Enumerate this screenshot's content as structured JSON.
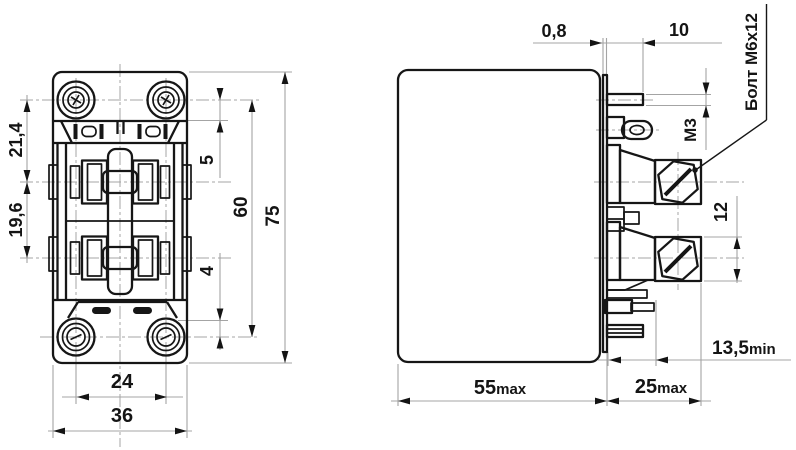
{
  "drawing": {
    "kind": "relay dimensional drawing, two views",
    "front_view": {
      "labels": {
        "hole_to_upper_contact": "21,4",
        "contact_row_spacing": "19,6",
        "top_screw_inset": "5",
        "bottom_screw_inset": "4",
        "mount_hole_vertical_spacing": "60",
        "overall_height": "75",
        "mount_hole_horizontal_spacing": "24",
        "overall_width": "36"
      }
    },
    "side_view": {
      "labels": {
        "flange_thickness": "0,8",
        "blade_terminal_length": "10",
        "terminal_thread": "М3",
        "contact_terminal_height": "12",
        "clearance_value": "13,5",
        "clearance_suffix": "min",
        "body_depth_value": "55",
        "body_depth_suffix": "max",
        "terminal_depth_value": "25",
        "terminal_depth_suffix": "max",
        "bolt_callout": "Болт М6х12"
      }
    },
    "colors": {
      "line": "#161616",
      "thin_line": "#a4a4a4",
      "background": "#ffffff"
    }
  }
}
